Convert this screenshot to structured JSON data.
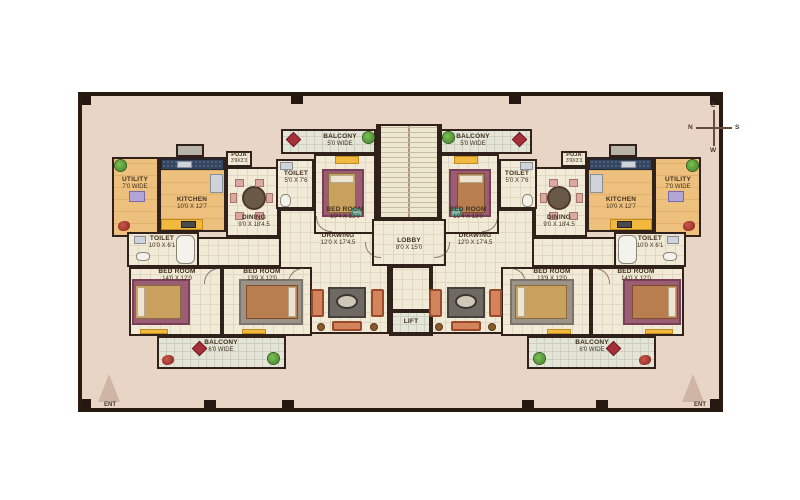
{
  "compass": {
    "top": "E",
    "left": "N",
    "right": "S",
    "bottom": "W"
  },
  "core": {
    "lobby": {
      "name": "LOBBY",
      "dims": "8'0 X 15'0"
    },
    "lift": {
      "name": "LIFT"
    }
  },
  "left": {
    "utility": {
      "name": "UTILITY",
      "dims": "7'0 WIDE"
    },
    "kitchen": {
      "name": "KITCHEN",
      "dims": "10'0 X 12'7"
    },
    "puja": {
      "name": "PUJA",
      "dims": "3'9X3'3"
    },
    "toilet_top": {
      "name": "TOILET",
      "dims": "5'0 X 7'6"
    },
    "balcony_top": {
      "name": "BALCONY",
      "dims": "5'0 WIDE"
    },
    "bedroom_top": {
      "name": "BED ROOM",
      "dims": "10'4 X 13'0"
    },
    "dining": {
      "name": "DINING",
      "dims": "9'0 X 18'4.5"
    },
    "drawing": {
      "name": "DRAWING",
      "dims": "12'0 X 17'4.5"
    },
    "toilet_low": {
      "name": "TOILET",
      "dims": "10'0 X 6'1"
    },
    "bedroom_low_outer": {
      "name": "BED ROOM",
      "dims": "14'0 X 12'0"
    },
    "bedroom_low_inner": {
      "name": "BED ROOM",
      "dims": "13'9 X 12'0"
    },
    "balcony_low": {
      "name": "BALCONY",
      "dims": "6'0 WIDE"
    },
    "entrance": "ENT"
  },
  "right": {
    "utility": {
      "name": "UTILITY",
      "dims": "7'0 WIDE"
    },
    "kitchen": {
      "name": "KITCHEN",
      "dims": "10'0 X 12'7"
    },
    "puja": {
      "name": "PUJA",
      "dims": "3'9X3'3"
    },
    "toilet_top": {
      "name": "TOILET",
      "dims": "5'0 X 7'6"
    },
    "balcony_top": {
      "name": "BALCONY",
      "dims": "5'0 WIDE"
    },
    "bedroom_top": {
      "name": "BED ROOM",
      "dims": "10'4 X 13'0"
    },
    "dining": {
      "name": "DINING",
      "dims": "9'0 X 18'4.5"
    },
    "drawing": {
      "name": "DRAWING",
      "dims": "12'0 X 17'4.5"
    },
    "toilet_low": {
      "name": "TOILET",
      "dims": "10'0 X 6'1"
    },
    "bedroom_low_outer": {
      "name": "BED ROOM",
      "dims": "14'0 X 12'0"
    },
    "bedroom_low_inner": {
      "name": "BED ROOM",
      "dims": "13'9 X 12'0"
    },
    "balcony_low": {
      "name": "BALCONY",
      "dims": "6'0 WIDE"
    },
    "entrance": "ENT"
  },
  "colors": {
    "page_bg": "#ffffff",
    "plan_bg": "#e9d5c6",
    "wall": "#2a1b12",
    "floor_cream": "#f0ead7",
    "room_tan": "#eec07d",
    "balcony_floor": "#e4e5d7",
    "counter_navy": "#33465e",
    "accent_yellow": "#f2b93f",
    "rug_plum": "#9a5d74",
    "bed_tan": "#c9a15f",
    "bed_brown": "#b97e4f",
    "rug_gray": "#9b9388",
    "sofa_salmon": "#d4845c",
    "mat_red": "#a5303a",
    "plant_green": "#4e9a3c",
    "text": "#41301f"
  }
}
